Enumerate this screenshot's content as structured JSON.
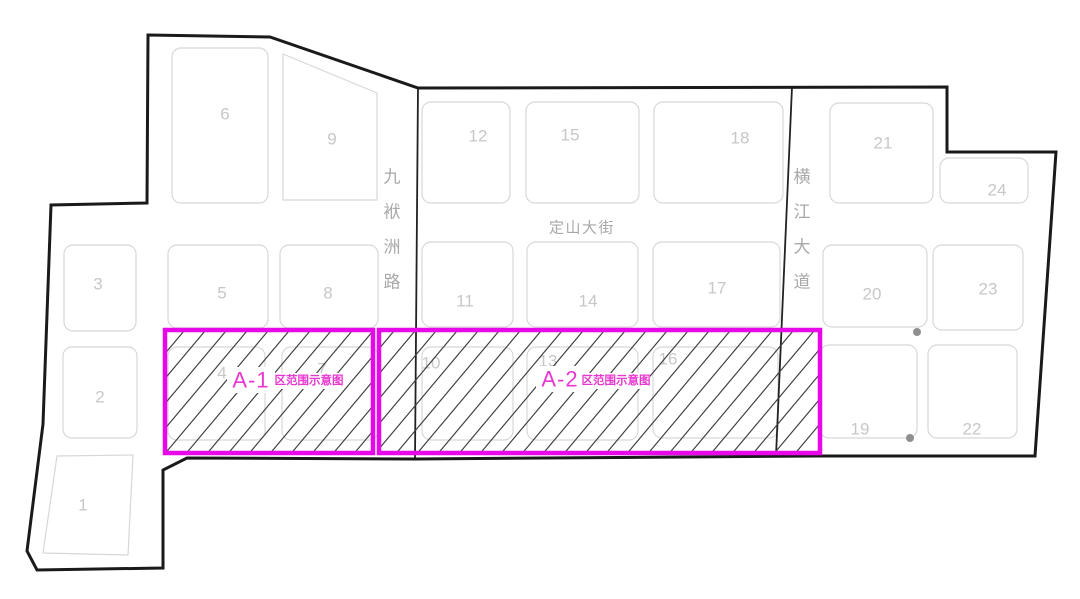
{
  "map": {
    "description": "land-parcel zoning plan",
    "colors": {
      "background": "#ffffff",
      "boundary": "#1a1a1a",
      "road_line": "#222222",
      "parcel_stroke": "#d7d7d7",
      "parcel_number": "#c7c7c7",
      "street_text": "#a8a8a8",
      "hatch_line": "#3d3d3d",
      "zone_border": "#e807e8",
      "zone_label": "#e838d0",
      "dot": "#8f8f8f"
    },
    "boundary_path": "M148,35 L270,37 L418,88 L947,87 L947,152 L1056,152 L1035,456 L818,456 L415,459 L187,458 L163,470 L163,568 L37,570 L27,551 L43,424 L51,205 L147,203 Z",
    "road_lines": [
      {
        "id": "jiufuzhou-road-east-edge",
        "x1": 418,
        "y1": 88,
        "x2": 415,
        "y2": 459
      },
      {
        "id": "hengjiang-avenue-west-edge",
        "x1": 792,
        "y1": 87,
        "x2": 776,
        "y2": 456
      }
    ],
    "streets": [
      {
        "id": "jiufuzhou-road",
        "name": "九袱洲路",
        "orientation": "vertical",
        "x": 392,
        "y": 177,
        "char_step": 35,
        "font_size": 17
      },
      {
        "id": "dingshan-street",
        "name": "定山大街",
        "orientation": "horizontal",
        "x": 582,
        "y": 228,
        "char_step": 0,
        "font_size": 15
      },
      {
        "id": "hengjiang-avenue",
        "name": "横江大道",
        "orientation": "vertical",
        "x": 802,
        "y": 177,
        "char_step": 35,
        "font_size": 17
      }
    ],
    "parcels": [
      {
        "id": "1",
        "label": "1",
        "poly": [
          [
            57,
            456
          ],
          [
            133,
            455
          ],
          [
            128,
            555
          ],
          [
            43,
            553
          ]
        ],
        "label_x": 83,
        "label_y": 505
      },
      {
        "id": "2",
        "label": "2",
        "rect": [
          63,
          347,
          74,
          91
        ],
        "label_x": 100,
        "label_y": 397
      },
      {
        "id": "3",
        "label": "3",
        "rect": [
          64,
          245,
          72,
          86
        ],
        "label_x": 98,
        "label_y": 284
      },
      {
        "id": "4",
        "label": "4",
        "rect": [
          168,
          347,
          97,
          93
        ],
        "label_x": 222,
        "label_y": 373
      },
      {
        "id": "5",
        "label": "5",
        "rect": [
          168,
          245,
          100,
          83
        ],
        "label_x": 222,
        "label_y": 293
      },
      {
        "id": "6",
        "label": "6",
        "rect": [
          172,
          48,
          96,
          155
        ],
        "label_x": 225,
        "label_y": 114
      },
      {
        "id": "7",
        "label": "7",
        "rect": [
          282,
          347,
          96,
          93
        ],
        "label_x": 322,
        "label_y": 369
      },
      {
        "id": "8",
        "label": "8",
        "rect": [
          280,
          245,
          98,
          83
        ],
        "label_x": 328,
        "label_y": 293
      },
      {
        "id": "9",
        "label": "9",
        "poly": [
          [
            283,
            54
          ],
          [
            377,
            93
          ],
          [
            377,
            200
          ],
          [
            283,
            200
          ]
        ],
        "label_x": 332,
        "label_y": 139
      },
      {
        "id": "10",
        "label": "10",
        "rect": [
          422,
          347,
          91,
          93
        ],
        "label_x": 431,
        "label_y": 363
      },
      {
        "id": "11",
        "label": "11",
        "rect": [
          422,
          242,
          91,
          85
        ],
        "label_x": 465,
        "label_y": 301
      },
      {
        "id": "12",
        "label": "12",
        "rect": [
          422,
          102,
          88,
          101
        ],
        "label_x": 478,
        "label_y": 136
      },
      {
        "id": "13",
        "label": "13",
        "rect": [
          527,
          347,
          111,
          93
        ],
        "label_x": 548,
        "label_y": 361
      },
      {
        "id": "14",
        "label": "14",
        "rect": [
          527,
          242,
          111,
          85
        ],
        "label_x": 588,
        "label_y": 301
      },
      {
        "id": "15",
        "label": "15",
        "rect": [
          526,
          102,
          113,
          101
        ],
        "label_x": 570,
        "label_y": 135
      },
      {
        "id": "16",
        "label": "16",
        "rect": [
          653,
          347,
          125,
          91
        ],
        "label_x": 668,
        "label_y": 359
      },
      {
        "id": "17",
        "label": "17",
        "rect": [
          653,
          242,
          127,
          85
        ],
        "label_x": 717,
        "label_y": 288
      },
      {
        "id": "18",
        "label": "18",
        "rect": [
          654,
          102,
          129,
          101
        ],
        "label_x": 740,
        "label_y": 138
      },
      {
        "id": "19",
        "label": "19",
        "rect": [
          820,
          345,
          97,
          93
        ],
        "label_x": 860,
        "label_y": 429
      },
      {
        "id": "20",
        "label": "20",
        "rect": [
          823,
          245,
          104,
          82
        ],
        "label_x": 872,
        "label_y": 294
      },
      {
        "id": "21",
        "label": "21",
        "rect": [
          830,
          103,
          103,
          100
        ],
        "label_x": 883,
        "label_y": 143
      },
      {
        "id": "22",
        "label": "22",
        "rect": [
          928,
          345,
          89,
          93
        ],
        "label_x": 972,
        "label_y": 429
      },
      {
        "id": "23",
        "label": "23",
        "rect": [
          933,
          245,
          90,
          85
        ],
        "label_x": 988,
        "label_y": 289
      },
      {
        "id": "24",
        "label": "24",
        "rect": [
          940,
          158,
          88,
          45
        ],
        "label_x": 997,
        "label_y": 190
      }
    ],
    "zones": [
      {
        "id": "A-1",
        "label_main": "A-1",
        "label_sub": "区范围示意图",
        "x": 165,
        "y": 330,
        "w": 208,
        "h": 123,
        "label_main_x": 251,
        "label_main_y": 380,
        "label_sub_x": 309,
        "label_sub_y": 381
      },
      {
        "id": "A-2",
        "label_main": "A-2",
        "label_sub": "区范围示意图",
        "x": 379,
        "y": 330,
        "w": 441,
        "h": 123,
        "label_main_x": 560,
        "label_main_y": 379,
        "label_sub_x": 616,
        "label_sub_y": 381
      }
    ],
    "dots": [
      {
        "x": 917,
        "y": 332,
        "r": 4
      },
      {
        "x": 910,
        "y": 438,
        "r": 4
      }
    ],
    "hatch": {
      "h_spacing": 21,
      "v_rise": 25,
      "stroke_width": 1.2
    }
  }
}
